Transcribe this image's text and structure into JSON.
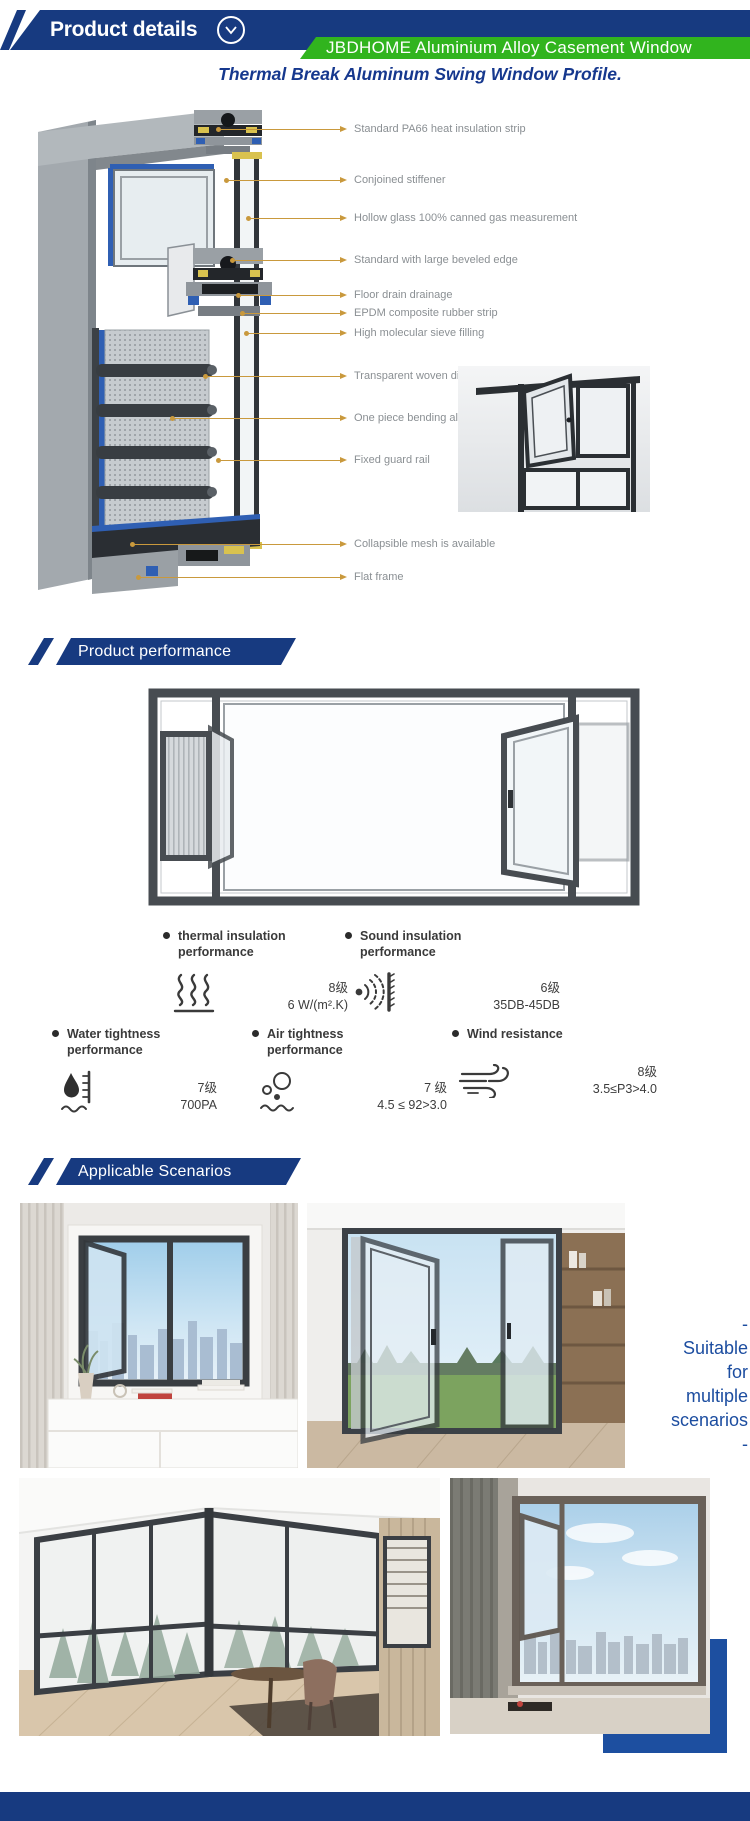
{
  "header": {
    "title": "Product details",
    "chevron_icon": "chevron-down-icon",
    "ribbon_text": "JBDHOME Aluminium Alloy Casement Window"
  },
  "intro_title": "Thermal Break Aluminum Swing Window Profile.",
  "diagram": {
    "callouts": [
      {
        "label": "Standard PA66 heat insulation strip"
      },
      {
        "label": "Conjoined stiffener"
      },
      {
        "label": "Hollow glass 100% canned gas measurement"
      },
      {
        "label": "Standard with large beveled edge"
      },
      {
        "label": "Floor drain drainage"
      },
      {
        "label": "EPDM composite rubber strip"
      },
      {
        "label": "High molecular sieve filling"
      },
      {
        "label": "Transparent woven diamond gauze"
      },
      {
        "label": "One piece bending aluminum strip"
      },
      {
        "label": "Fixed guard rail"
      },
      {
        "label": "Collapsible mesh is available"
      },
      {
        "label": "Flat frame"
      }
    ]
  },
  "performance": {
    "section_title": "Product performance",
    "metrics": [
      {
        "label": "thermal insulation performance",
        "grade": "8级",
        "value": "6 W/(m².K)",
        "icon": "heat-waves-icon"
      },
      {
        "label": "Sound insulation performance",
        "grade": "6级",
        "value": "35DB-45DB",
        "icon": "sound-waves-icon"
      },
      {
        "label": "Water tightness performance",
        "grade": "7级",
        "value": "700PA",
        "icon": "water-drop-gauge-icon"
      },
      {
        "label": "Air tightness performance",
        "grade": "7 级",
        "value": "4.5 ≤ 92>3.0",
        "icon": "air-bubbles-icon"
      },
      {
        "label": "Wind resistance",
        "grade": "8级",
        "value": "3.5≤P3>4.0",
        "icon": "wind-icon"
      }
    ]
  },
  "scenarios": {
    "section_title": "Applicable Scenarios",
    "caption_lines": [
      "-",
      "Suitable",
      "for",
      "multiple",
      "scenarios",
      "-"
    ]
  },
  "colors": {
    "navy": "#173a80",
    "green": "#31b41e",
    "title_blue": "#16388e",
    "callout_line": "#c9993d",
    "callout_text": "#8a8f93",
    "caption_blue": "#1c4da0",
    "accent_rect": "#1d4fa0"
  }
}
